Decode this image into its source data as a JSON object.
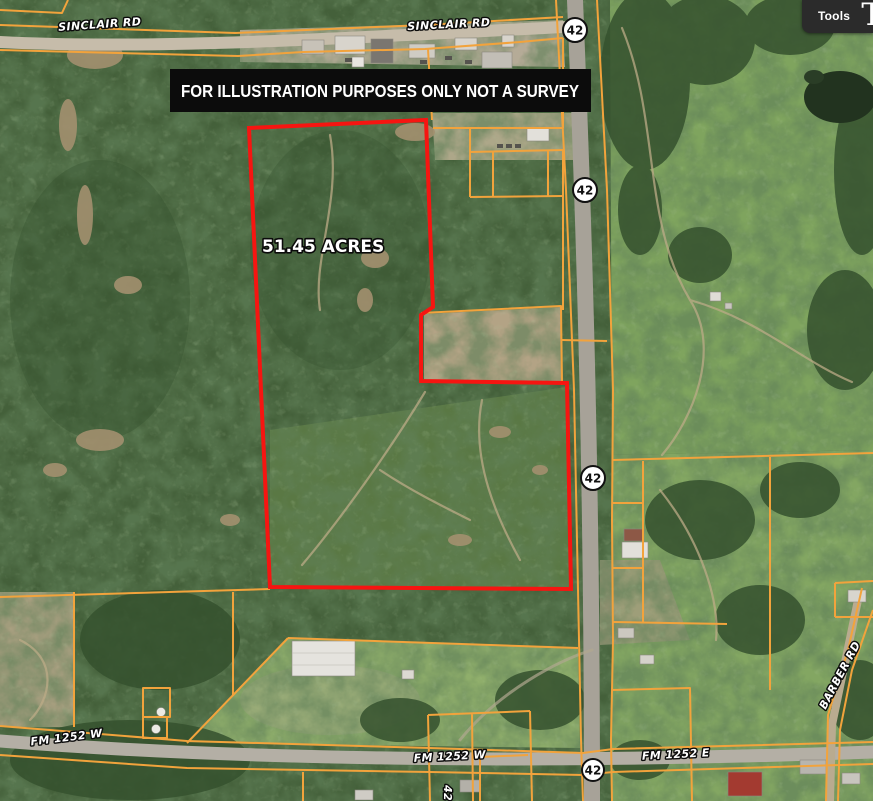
{
  "toolbar": {
    "tools_label": "Tools",
    "logo_glyph": "T"
  },
  "banner": {
    "text": "FOR ILLUSTRATION PURPOSES ONLY NOT A SURVEY"
  },
  "parcel": {
    "acreage_label": "51.45 ACRES"
  },
  "map": {
    "road_labels": {
      "sinclair_west": "SINCLAIR RD",
      "sinclair_east": "SINCLAIR RD",
      "fm1252_w_left": "FM 1252 W",
      "fm1252_w_center": "FM 1252 W",
      "fm1252_e": "FM 1252 E",
      "barber": "BARBER RD",
      "county_road_vertical": "42"
    },
    "highway_badges": [
      {
        "text": "42"
      },
      {
        "text": "42"
      },
      {
        "text": "42"
      },
      {
        "text": "42"
      }
    ],
    "colors": {
      "parcel_line": "#f2a33c",
      "subject_boundary": "#f61511",
      "banner_bg": "#0c0c0c",
      "toolbar_bg": "#2b2b2b"
    }
  }
}
